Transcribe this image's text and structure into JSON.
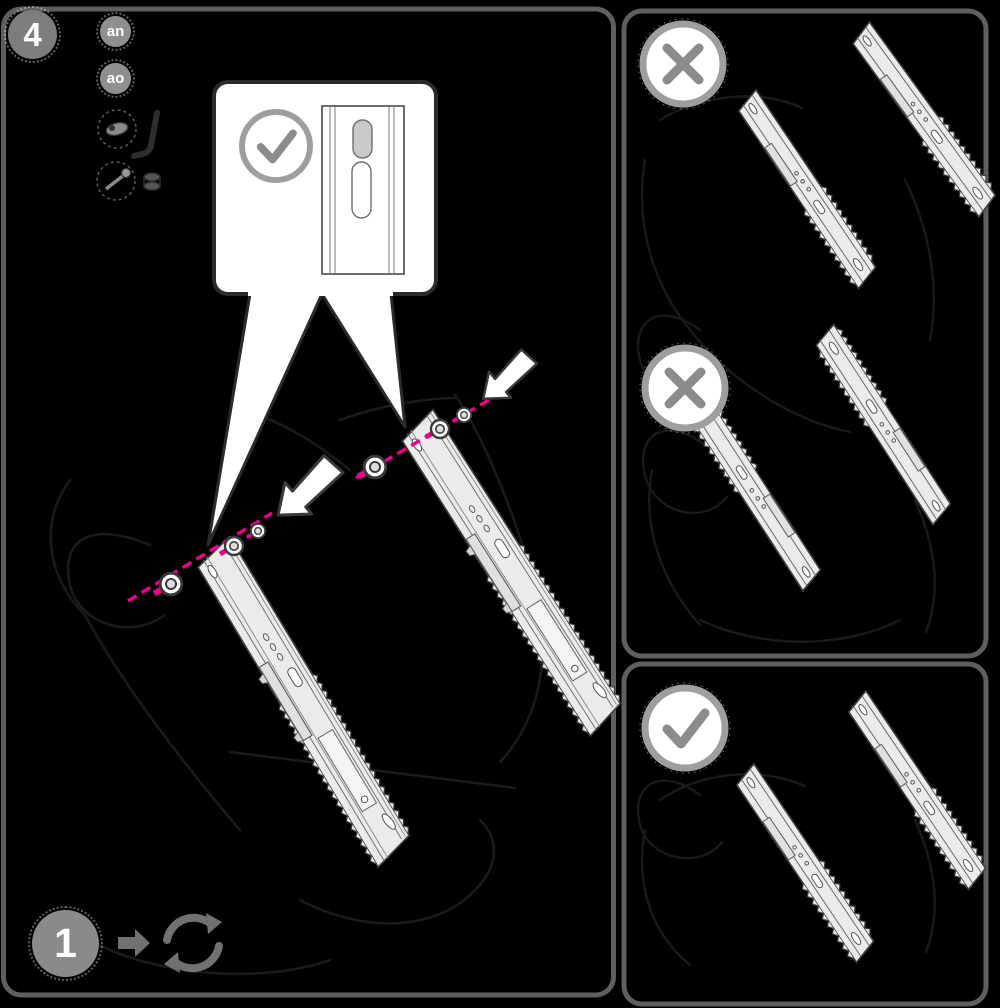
{
  "colors": {
    "background": "#000000",
    "panel_border": "#5f5f5f",
    "accent_pink": "#ec008c",
    "step_gray": "#7d7d7d",
    "badge_gray": "#8f8f8f",
    "ring_gray": "#9e9e9e",
    "mark_gray": "#8c8c8c",
    "rail_fill": "#ebebeb",
    "line_dark": "#3f3f3f",
    "sketch_dark": "#1a1a1a",
    "tool_gray": "#717171",
    "callout_border": "#2b2b2b"
  },
  "step": {
    "number": "4"
  },
  "part_badges": [
    {
      "label": "an"
    },
    {
      "label": "ao"
    }
  ],
  "hardware_icons": [
    "barrel-nut-icon",
    "allen-key-icon",
    "screw-icon",
    "cam-lock-icon"
  ],
  "callout": {
    "mark": "check",
    "slot_count": "2"
  },
  "result_panels": [
    {
      "mark": "cross"
    },
    {
      "mark": "cross"
    },
    {
      "mark": "check"
    }
  ],
  "footer": {
    "step_number": "1",
    "icons": [
      "arrow-right-icon",
      "rotate-repeat-icon"
    ]
  }
}
